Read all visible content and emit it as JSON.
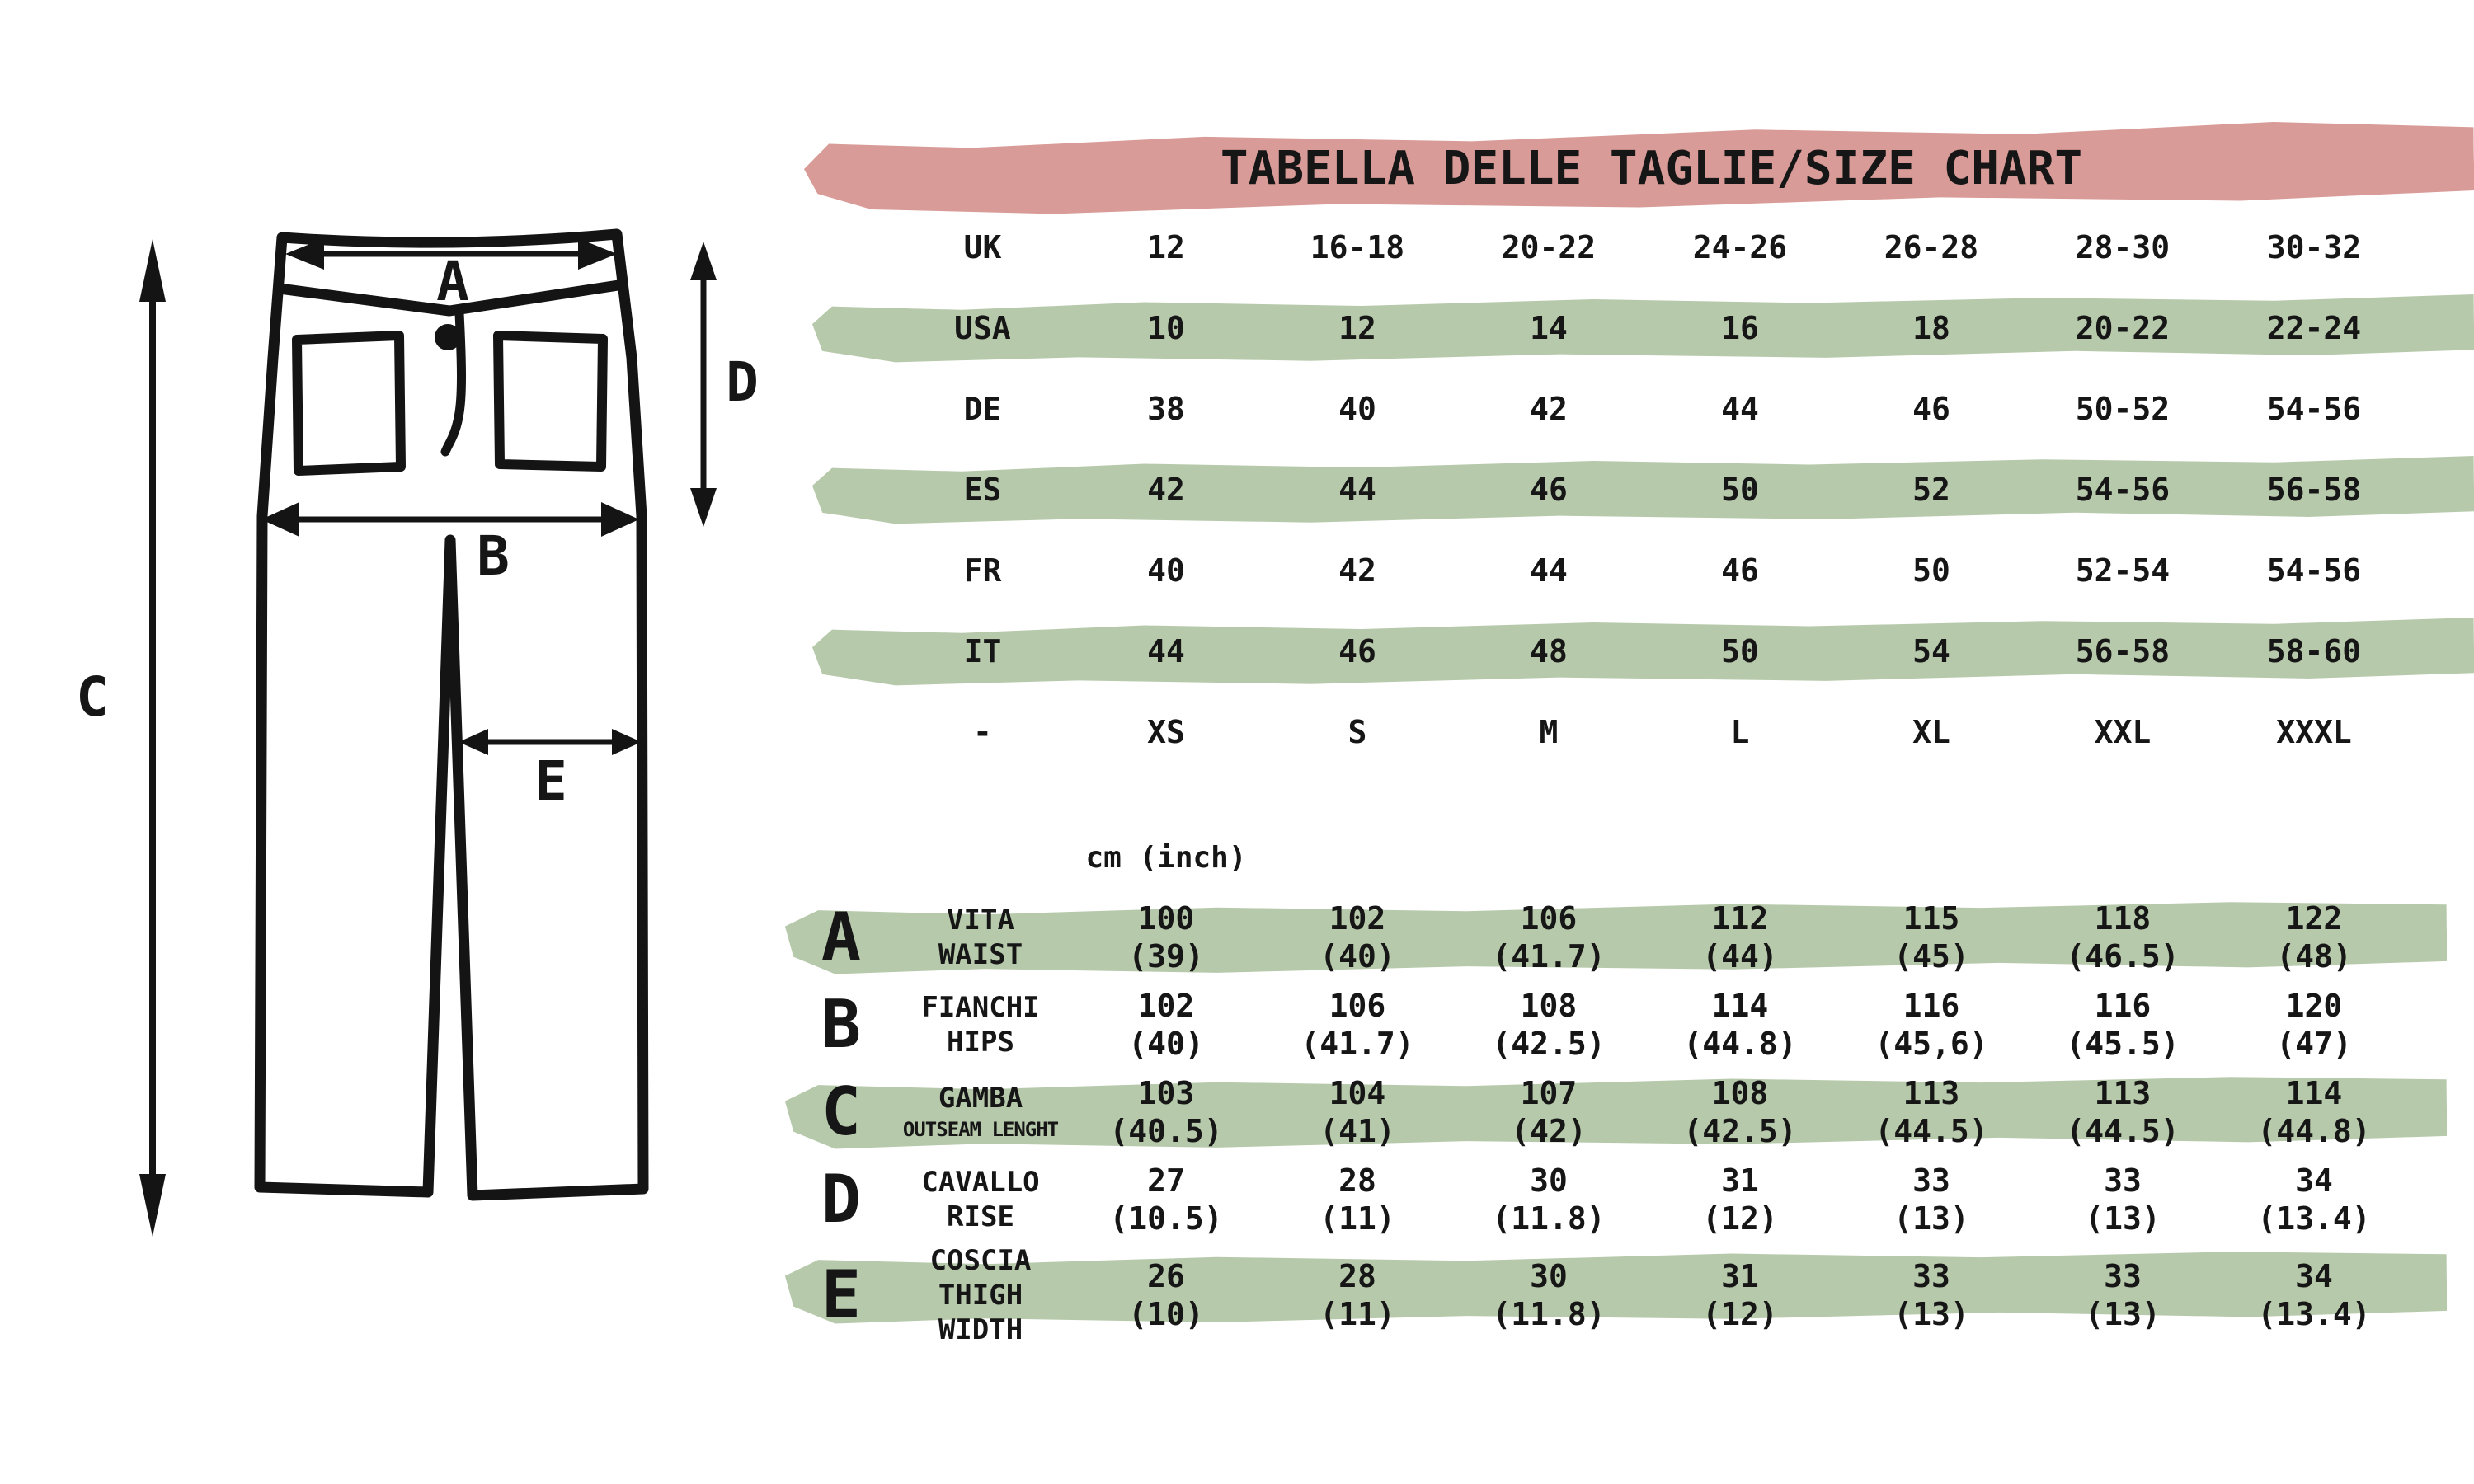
{
  "title": "TABELLA DELLE TAGLIE/SIZE CHART",
  "units_label": "cm (inch)",
  "colors": {
    "header_pink": "#d89b97",
    "stripe_green": "#b7c9ab",
    "ink": "#161616"
  },
  "diagram": {
    "labels": {
      "a": "A",
      "b": "B",
      "c": "C",
      "d": "D",
      "e": "E"
    }
  },
  "size_table": {
    "rows": [
      {
        "label": "UK",
        "highlight": false,
        "cells": [
          "12",
          "16-18",
          "20-22",
          "24-26",
          "26-28",
          "28-30",
          "30-32"
        ]
      },
      {
        "label": "USA",
        "highlight": true,
        "cells": [
          "10",
          "12",
          "14",
          "16",
          "18",
          "20-22",
          "22-24"
        ]
      },
      {
        "label": "DE",
        "highlight": false,
        "cells": [
          "38",
          "40",
          "42",
          "44",
          "46",
          "50-52",
          "54-56"
        ]
      },
      {
        "label": "ES",
        "highlight": true,
        "cells": [
          "42",
          "44",
          "46",
          "50",
          "52",
          "54-56",
          "56-58"
        ]
      },
      {
        "label": "FR",
        "highlight": false,
        "cells": [
          "40",
          "42",
          "44",
          "46",
          "50",
          "52-54",
          "54-56"
        ]
      },
      {
        "label": "IT",
        "highlight": true,
        "cells": [
          "44",
          "46",
          "48",
          "50",
          "54",
          "56-58",
          "58-60"
        ]
      },
      {
        "label": "-",
        "highlight": false,
        "cells": [
          "XS",
          "S",
          "M",
          "L",
          "XL",
          "XXL",
          "XXXL"
        ]
      }
    ]
  },
  "measure_table": {
    "rows": [
      {
        "letter": "A",
        "name_it": "VITA",
        "name_en": "WAIST",
        "highlight": true,
        "small_en": false,
        "cells": [
          {
            "cm": "100",
            "in": "(39)"
          },
          {
            "cm": "102",
            "in": "(40)"
          },
          {
            "cm": "106",
            "in": "(41.7)"
          },
          {
            "cm": "112",
            "in": "(44)"
          },
          {
            "cm": "115",
            "in": "(45)"
          },
          {
            "cm": "118",
            "in": "(46.5)"
          },
          {
            "cm": "122",
            "in": "(48)"
          }
        ]
      },
      {
        "letter": "B",
        "name_it": "FIANCHI",
        "name_en": "HIPS",
        "highlight": false,
        "small_en": false,
        "cells": [
          {
            "cm": "102",
            "in": "(40)"
          },
          {
            "cm": "106",
            "in": "(41.7)"
          },
          {
            "cm": "108",
            "in": "(42.5)"
          },
          {
            "cm": "114",
            "in": "(44.8)"
          },
          {
            "cm": "116",
            "in": "(45,6)"
          },
          {
            "cm": "116",
            "in": "(45.5)"
          },
          {
            "cm": "120",
            "in": "(47)"
          }
        ]
      },
      {
        "letter": "C",
        "name_it": "GAMBA",
        "name_en": "OUTSEAM LENGHT",
        "highlight": true,
        "small_en": true,
        "cells": [
          {
            "cm": "103",
            "in": "(40.5)"
          },
          {
            "cm": "104",
            "in": "(41)"
          },
          {
            "cm": "107",
            "in": "(42)"
          },
          {
            "cm": "108",
            "in": "(42.5)"
          },
          {
            "cm": "113",
            "in": "(44.5)"
          },
          {
            "cm": "113",
            "in": "(44.5)"
          },
          {
            "cm": "114",
            "in": "(44.8)"
          }
        ]
      },
      {
        "letter": "D",
        "name_it": "CAVALLO",
        "name_en": "RISE",
        "highlight": false,
        "small_en": false,
        "cells": [
          {
            "cm": "27",
            "in": "(10.5)"
          },
          {
            "cm": "28",
            "in": "(11)"
          },
          {
            "cm": "30",
            "in": "(11.8)"
          },
          {
            "cm": "31",
            "in": "(12)"
          },
          {
            "cm": "33",
            "in": "(13)"
          },
          {
            "cm": "33",
            "in": "(13)"
          },
          {
            "cm": "34",
            "in": "(13.4)"
          }
        ]
      },
      {
        "letter": "E",
        "name_it": "COSCIA",
        "name_en": "THIGH WIDTH",
        "highlight": true,
        "small_en": false,
        "cells": [
          {
            "cm": "26",
            "in": "(10)"
          },
          {
            "cm": "28",
            "in": "(11)"
          },
          {
            "cm": "30",
            "in": "(11.8)"
          },
          {
            "cm": "31",
            "in": "(12)"
          },
          {
            "cm": "33",
            "in": "(13)"
          },
          {
            "cm": "33",
            "in": "(13)"
          },
          {
            "cm": "34",
            "in": "(13.4)"
          }
        ]
      }
    ]
  }
}
